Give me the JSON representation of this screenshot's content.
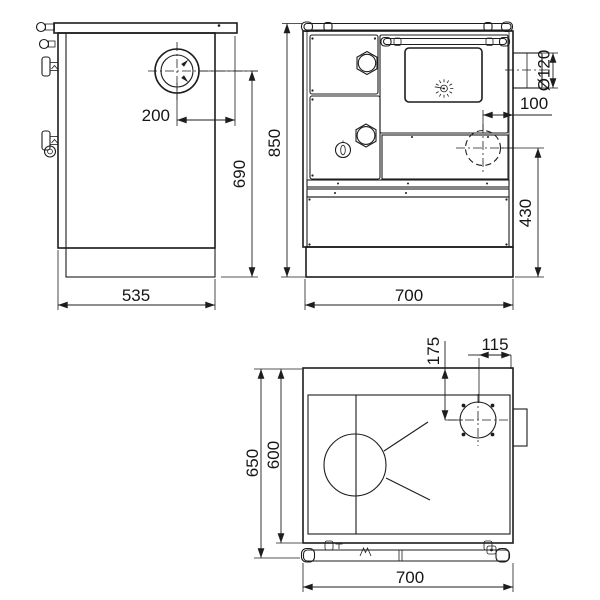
{
  "drawing": {
    "type": "technical-orthographic-views",
    "subject": "solid-fuel cooking stove",
    "colors": {
      "background": "#ffffff",
      "line": "#1d1d1d",
      "text": "#161616"
    },
    "views": {
      "side": {
        "dims": {
          "flue_offset_from_back": "200",
          "flue_center_height": "690",
          "depth": "535"
        }
      },
      "front": {
        "dims": {
          "overall_height": "850",
          "flue_outlet_diameter": "Ø120",
          "side_flue_offset": "100",
          "side_flue_height": "430",
          "overall_width": "700"
        }
      },
      "top": {
        "dims": {
          "flue_from_back_edge": "175",
          "flue_from_right_edge": "115",
          "overall_depth": "650",
          "body_depth": "600",
          "overall_width": "700"
        }
      }
    }
  }
}
